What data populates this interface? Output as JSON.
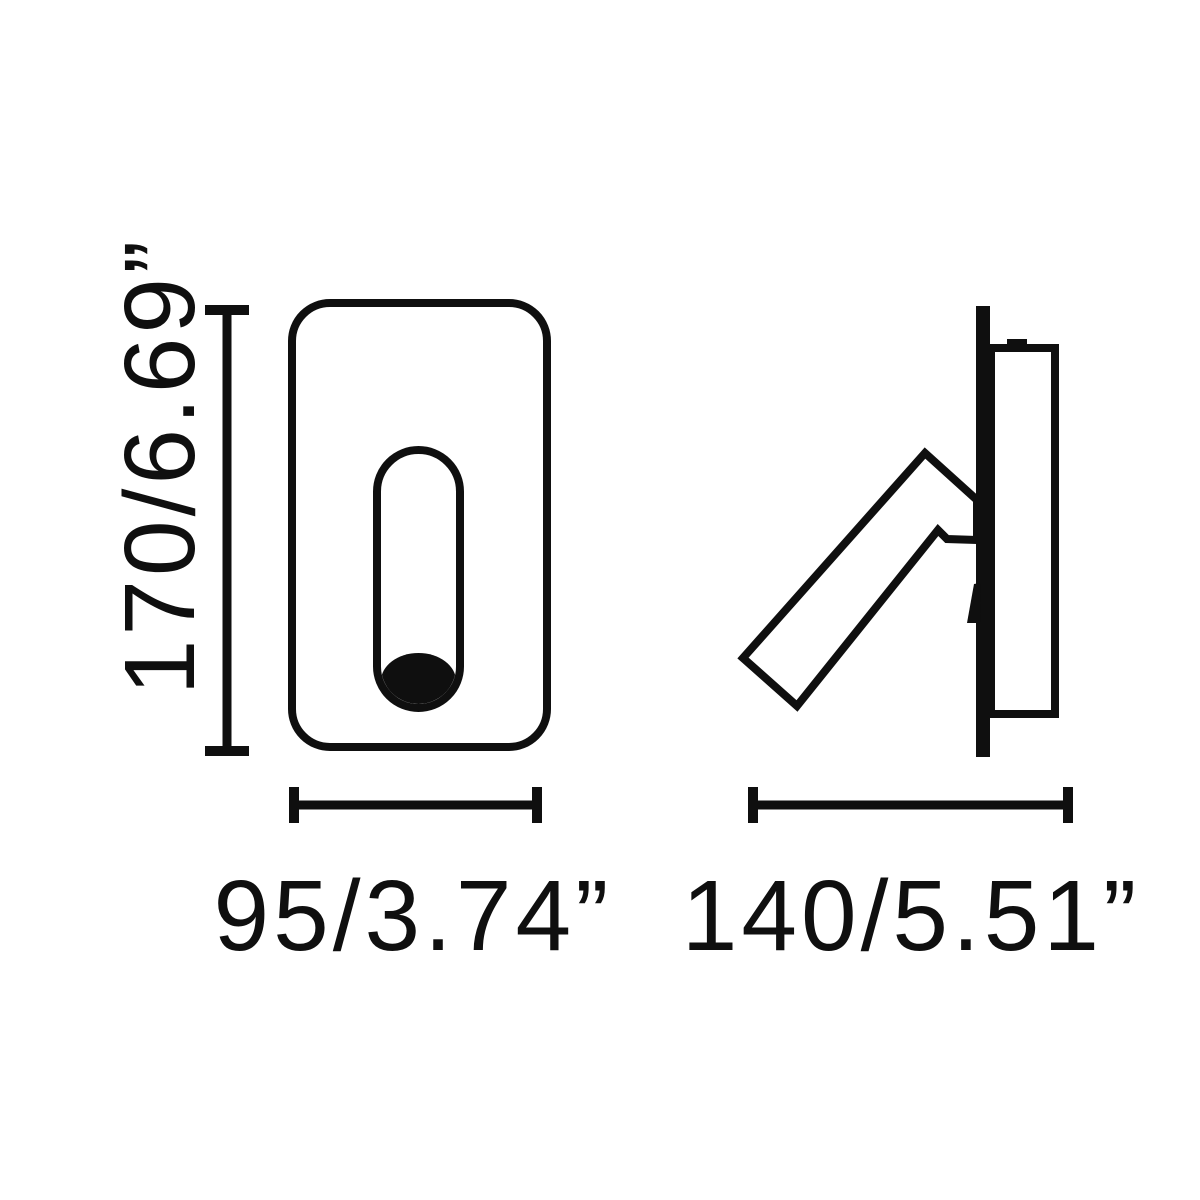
{
  "canvas": {
    "width_px": 1200,
    "height_px": 1200,
    "background": "#ffffff",
    "ink": "#0f0f0f"
  },
  "drawing": {
    "kind": "dimensioned technical line drawing",
    "subject": "recessed wall reading lamp, front view and side view",
    "views": {
      "front": "front view: rounded rectangular face plate with vertical slot and lamp tube at slot bottom",
      "side": "side view: wall plate edge, recessed housing with tab, adjustable reading-light arm tilted about 48 degrees with mounting bracket and cable"
    },
    "dimensions": {
      "height": {
        "label": "170/6.69”",
        "millimeters": 170,
        "inches": 6.69
      },
      "front_width": {
        "label": "95/3.74”",
        "millimeters": 95,
        "inches": 3.74
      },
      "side_depth": {
        "label": "140/5.51”",
        "millimeters": 140,
        "inches": 5.51
      }
    }
  }
}
